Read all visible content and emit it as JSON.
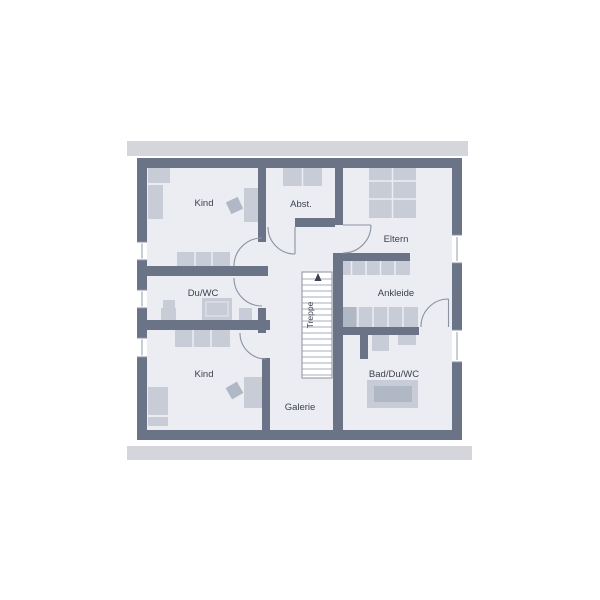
{
  "plan": {
    "type": "floor-plan",
    "language": "de"
  },
  "rooms": {
    "kind_top": {
      "label": "Kind"
    },
    "abstellraum": {
      "label": "Abst."
    },
    "eltern": {
      "label": "Eltern"
    },
    "du_wc": {
      "label": "Du/WC"
    },
    "ankleide": {
      "label": "Ankleide"
    },
    "kind_bottom": {
      "label": "Kind"
    },
    "bad_du_wc": {
      "label": "Bad/Du/WC"
    },
    "galerie": {
      "label": "Galerie"
    }
  },
  "stairs": {
    "label": "Treppe",
    "direction": "up"
  },
  "colors": {
    "bg": "#ffffff",
    "floor": "#ecedf2",
    "wall": "#6b7487",
    "roof": "#d4d6dc",
    "furn": "#c7ccd7",
    "furn2": "#b0b7c5",
    "line": "#8a93a2",
    "ink": "#3c4250"
  }
}
